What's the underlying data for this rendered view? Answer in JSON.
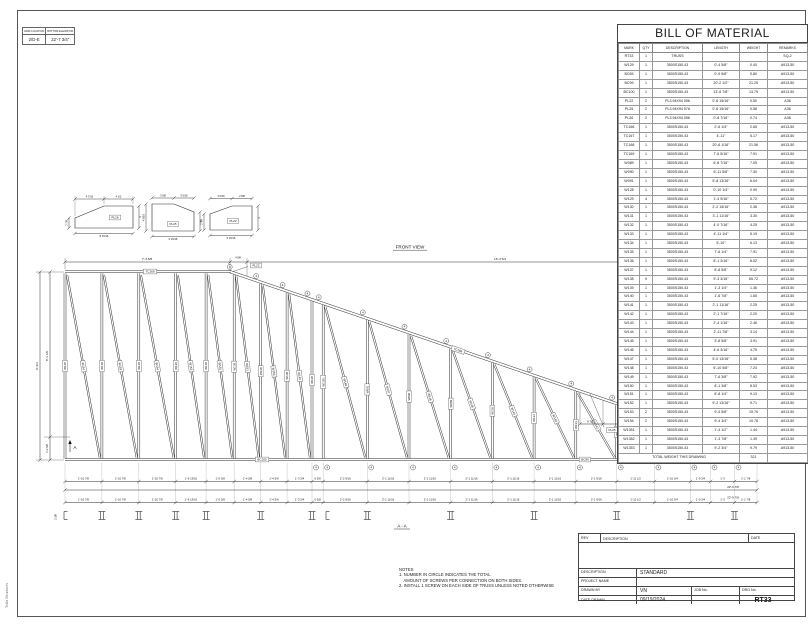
{
  "sheet": {
    "side_text": "Tekla Structures",
    "front_view_label": "FRONT VIEW",
    "section_label": "A - A",
    "section_marker": "A",
    "info_box": {
      "headers": [
        "GRID LOCATION",
        "BOTTOM ELEVATION"
      ],
      "values": [
        "2/D-E",
        "22'-7 3/4\""
      ]
    }
  },
  "bom": {
    "title": "BILL OF MATERIAL",
    "headers": [
      "MARK",
      "QTY",
      "DESCRIPTION",
      "LENGTH",
      "WEIGHT",
      "REMARKS"
    ],
    "rows": [
      [
        "RT33",
        "1",
        "TRUSS",
        "",
        "",
        "SQ-2"
      ],
      [
        "W129",
        "1",
        "3500S150-43",
        "0'-4 5/8\"",
        "0.40",
        "A913-50"
      ],
      [
        "BC65",
        "1",
        "3500S150-43",
        "0'-9 5/8\"",
        "0.80",
        "A913-50"
      ],
      [
        "BC99",
        "1",
        "3500S150-43",
        "20'-2 1/2\"",
        "21.25",
        "A913-50"
      ],
      [
        "BC100",
        "1",
        "3500S150-43",
        "13'-6 7/8\"",
        "13.75",
        "A913-50"
      ],
      [
        "PL22",
        "2",
        "PL3.94X94 056",
        "0'-6 15/16\"",
        "0.50",
        "A36"
      ],
      [
        "PL25",
        "2",
        "PL3.94X94 578",
        "0'-6 15/16\"",
        "0.58",
        "A36"
      ],
      [
        "PL26",
        "2",
        "PL3.94X94 056",
        "0'-8 7/16\"",
        "0.74",
        "A36"
      ],
      [
        "TC166",
        "1",
        "3500S150-43",
        "2'-6 1/4\"",
        "2.65",
        "A913-50"
      ],
      [
        "TC167",
        "1",
        "3500S150-43",
        "4'-11\"",
        "5.17",
        "A913-50"
      ],
      [
        "TC168",
        "1",
        "3500S150-43",
        "20'-6 1/16\"",
        "21.56",
        "A913-50"
      ],
      [
        "TC169",
        "1",
        "3500S150-43",
        "7'-6 5/16\"",
        "7.91",
        "A913-50"
      ],
      [
        "W089",
        "1",
        "3500S150-43",
        "6'-8 7/16\"",
        "7.05",
        "A913-50"
      ],
      [
        "W090",
        "1",
        "3500S150-43",
        "6'-11 5/8\"",
        "7.30",
        "A913-50"
      ],
      [
        "W091",
        "1",
        "3500S150-43",
        "5'-8 13/16\"",
        "6.04",
        "A913-50"
      ],
      [
        "W128",
        "1",
        "3500S150-43",
        "0'-10 1/4\"",
        "0.90",
        "A913-50"
      ],
      [
        "W129",
        "4",
        "3500S150-43",
        "1'-4 9/16\"",
        "5.72",
        "A913-50"
      ],
      [
        "W130",
        "1",
        "3500S150-43",
        "2'-2 15/16\"",
        "2.36",
        "A913-50"
      ],
      [
        "W131",
        "1",
        "3500S150-43",
        "3'-1 11/16\"",
        "3.30",
        "A913-50"
      ],
      [
        "W132",
        "1",
        "3500S150-43",
        "4'-0 7/16\"",
        "4.25",
        "A913-50"
      ],
      [
        "W133",
        "1",
        "3500S150-43",
        "4'-11 1/4\"",
        "5.19",
        "A913-50"
      ],
      [
        "W134",
        "1",
        "3500S150-43",
        "5'-10\"",
        "6.13",
        "A913-50"
      ],
      [
        "W135",
        "1",
        "3500S150-43",
        "7'-6 1/4\"",
        "7.91",
        "A913-50"
      ],
      [
        "W136",
        "1",
        "3500S150-43",
        "8'-1 3/16\"",
        "8.52",
        "A913-50"
      ],
      [
        "W137",
        "1",
        "3500S150-43",
        "8'-8 5/8\"",
        "9.12",
        "A913-50"
      ],
      [
        "W138",
        "9",
        "3500S150-43",
        "9'-3 3/16\"",
        "65.72",
        "A913-50"
      ],
      [
        "W139",
        "1",
        "3500S150-43",
        "1'-3 1/4\"",
        "1.36",
        "A913-50"
      ],
      [
        "W140",
        "1",
        "3500S150-43",
        "1'-6 7/8\"",
        "1.65",
        "A913-50"
      ],
      [
        "W141",
        "1",
        "3500S150-43",
        "2'-1 11/16\"",
        "2.25",
        "A913-50"
      ],
      [
        "W142",
        "1",
        "3500S150-43",
        "2'-1 7/16\"",
        "2.20",
        "A913-50"
      ],
      [
        "W143",
        "1",
        "3500S150-43",
        "2'-4 1/16\"",
        "2.46",
        "A913-50"
      ],
      [
        "W144",
        "1",
        "3500S150-43",
        "2'-11 7/8\"",
        "3.14",
        "A913-50"
      ],
      [
        "W145",
        "1",
        "3500S150-43",
        "3'-8 5/8\"",
        "3.91",
        "A913-50"
      ],
      [
        "W146",
        "1",
        "3500S150-43",
        "4'-6 3/16\"",
        "4.75",
        "A913-50"
      ],
      [
        "W147",
        "1",
        "3500S150-43",
        "5'-0 13/16\"",
        "5.38",
        "A913-50"
      ],
      [
        "W148",
        "1",
        "3500S150-43",
        "6'-10 5/8\"",
        "7.24",
        "A913-50"
      ],
      [
        "W149",
        "1",
        "3500S150-43",
        "7'-6 3/8\"",
        "7.92",
        "A913-50"
      ],
      [
        "W150",
        "1",
        "3500S150-43",
        "8'-1 3/8\"",
        "8.53",
        "A913-50"
      ],
      [
        "W151",
        "1",
        "3500S150-43",
        "8'-8 1/4\"",
        "9.13",
        "A913-50"
      ],
      [
        "W152",
        "1",
        "3500S150-43",
        "9'-2 13/16\"",
        "9.71",
        "A913-50"
      ],
      [
        "W153",
        "2",
        "3500S150-43",
        "9'-4 5/8\"",
        "19.76",
        "A913-50"
      ],
      [
        "W154",
        "2",
        "3500S150-43",
        "9'-4 3/4\"",
        "19.78",
        "A913-50"
      ],
      [
        "W1351",
        "1",
        "3500S150-43",
        "1'-4 1/2\"",
        "1.44",
        "A913-50"
      ],
      [
        "W1352",
        "1",
        "3500S150-43",
        "1'-3 7/8\"",
        "1.39",
        "A913-50"
      ],
      [
        "W1353",
        "1",
        "3500S150-43",
        "9'-2 3/4\"",
        "9.79",
        "A913-50"
      ]
    ],
    "total_label": "TOTAL WEIGHT THIS DRAWING",
    "total_value": "321"
  },
  "truss": {
    "top_chord_labels": [
      "TC169",
      "TC168",
      "TC167",
      "TC166"
    ],
    "bottom_chord_labels": [
      "BC100",
      "BC99"
    ],
    "plate_labels": [
      "PL22",
      "PL25",
      "PL26"
    ],
    "extra_labels": [
      "W1353"
    ],
    "vertical_labels": [
      "W138",
      "W138",
      "W138",
      "W138",
      "W138",
      "W138",
      "W138",
      "W138",
      "W138",
      "W1351",
      "W091",
      "W090",
      "W089",
      "W135",
      "W134",
      "W133",
      "W132",
      "W131",
      "W130",
      "W128",
      "W1352"
    ],
    "diagonal_labels": [
      "W154",
      "W153",
      "W154",
      "W153",
      "W152",
      "W151",
      "W150",
      "W149",
      "",
      "W148",
      "W147",
      "W146",
      "W145",
      "W144",
      "W143",
      "W142",
      "W141",
      "W140",
      "W139",
      "W129",
      "W129"
    ],
    "screw_count": "4",
    "dims": {
      "top_left": "7'-3 5/8",
      "top_small": "4 5/8",
      "top_slope": "16'-3 3/4",
      "left": [
        "8'-3/4",
        "8'-1 1/8",
        "1'-2 5/8"
      ],
      "right_top": [
        "8 7/16",
        "6'-2 9/16",
        "8 7/16",
        "2'-0 9/16"
      ],
      "right_end": [
        "1 1/2",
        "4 5/8"
      ],
      "left_section": "2 3/8",
      "bottom_segments": [
        "1'-10 7/8",
        "1'-10 7/8",
        "1'-10 7/8",
        "1'-6 13/16",
        "1'-5 3/8",
        "1'-4 5/8",
        "1'-4 5/8",
        "1'-3 3/4",
        "6 5/8",
        "2'-2 9/16",
        "2'-1 11/16",
        "2'-1 11/16",
        "2'-1 11/16",
        "2'-1 11/16",
        "2'-1 11/16",
        "2'-1 9/16",
        "1'-11 1/2",
        "1'-10 3/4",
        "1'-0 3/4",
        "1'-3",
        "1'-1 7/8"
      ],
      "overall": "22'-9 7/8"
    }
  },
  "details": [
    {
      "label": "PL26",
      "top": [
        "4 7/16",
        "4 1/2"
      ],
      "left": "2 7/8",
      "right": "4",
      "bottom": "8 15/16"
    },
    {
      "label": "PL25",
      "top": [
        "3 5/8",
        "3 5/16"
      ],
      "left": "4 5/16",
      "right": "3",
      "bottom": "6 15/16"
    },
    {
      "label": "PL22",
      "top": [
        "4 5/16",
        "2 5/8"
      ],
      "left": "2 7/8",
      "right": "4",
      "bottom": "6 15/16"
    }
  ],
  "notes": {
    "title": "NOTES",
    "lines": [
      "1. NUMBER IN CIRCLE INDICATES THE TOTAL",
      "    AMOUNT OF SCREWS PER CONNECTION ON BOTH SIDES.",
      "2. INSTALL 1 SCREW ON EACH SIDE OF TRUSS UNLESS NOTED OTHERWISE"
    ]
  },
  "title_block": {
    "rev_header": [
      "REV",
      "DESCRIPTION",
      "DATE"
    ],
    "fields": [
      {
        "label": "DESCRIPTION",
        "value": "STANDARD"
      },
      {
        "label": "PROJECT NAME",
        "value": ""
      },
      {
        "label": "DRAWN BY",
        "value": "VN"
      },
      {
        "label": "DATE DRAWN",
        "value": "09/19/2024"
      }
    ],
    "job_no_label": "JOB No.",
    "drg_no_label": "DRG No.",
    "drg_no_value": "RT33"
  }
}
